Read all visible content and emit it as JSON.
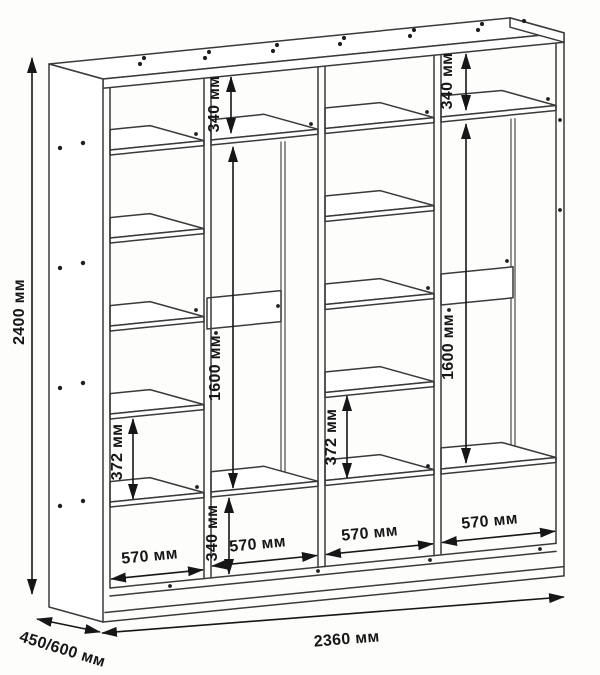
{
  "drawing": {
    "overall": {
      "height": "2400 мм",
      "width": "2360 мм",
      "depth": "450/600 мм"
    },
    "sections": [
      {
        "name": "shelf-column-left",
        "width": "570 мм",
        "shelf_gap": "372 мм"
      },
      {
        "name": "hanging-left",
        "width": "570 мм",
        "top_gap": "340 мм",
        "hanging_height": "1600 мм",
        "bottom_gap": "340 мм"
      },
      {
        "name": "shelf-column-right",
        "width": "570 мм",
        "shelf_gap": "372 мм"
      },
      {
        "name": "hanging-right",
        "width": "570 мм",
        "top_gap": "340 мм",
        "hanging_height": "1600 мм"
      }
    ],
    "colors": {
      "ink": "#3a3a3a",
      "dim_ink": "#161616",
      "paper": "#fdfdfc"
    }
  }
}
